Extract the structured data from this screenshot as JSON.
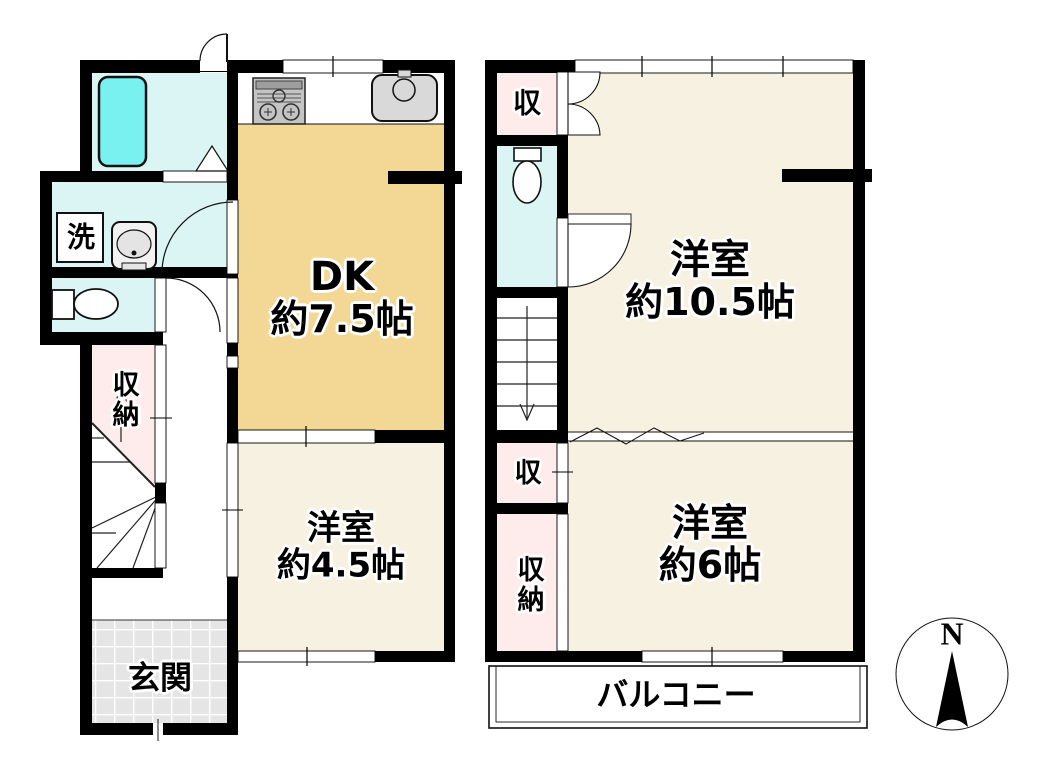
{
  "floor1": {
    "dining_kitchen": {
      "name": "DK",
      "size": "約7.5帖"
    },
    "western_room": {
      "name": "洋室",
      "size": "約4.5帖"
    },
    "entrance": "玄関",
    "storage": "収納",
    "laundry": "洗"
  },
  "floor2": {
    "western_room_large": {
      "name": "洋室",
      "size": "約10.5帖"
    },
    "western_room_small": {
      "name": "洋室",
      "size": "約6帖"
    },
    "closet_upper": "収",
    "closet_lower": "収",
    "storage": "収納",
    "balcony": "バルコニー"
  },
  "compass": {
    "north": "N"
  },
  "colors": {
    "wall": "#000000",
    "room_cream": "#f7f1e1",
    "room_tan": "#f3d895",
    "room_pink": "#fdeceb",
    "room_cyan": "#daf5f3",
    "bathtub_cyan": "#79f1f1",
    "tile_gray": "#e5e5e5",
    "fixture_gray": "#d9d9d9"
  }
}
